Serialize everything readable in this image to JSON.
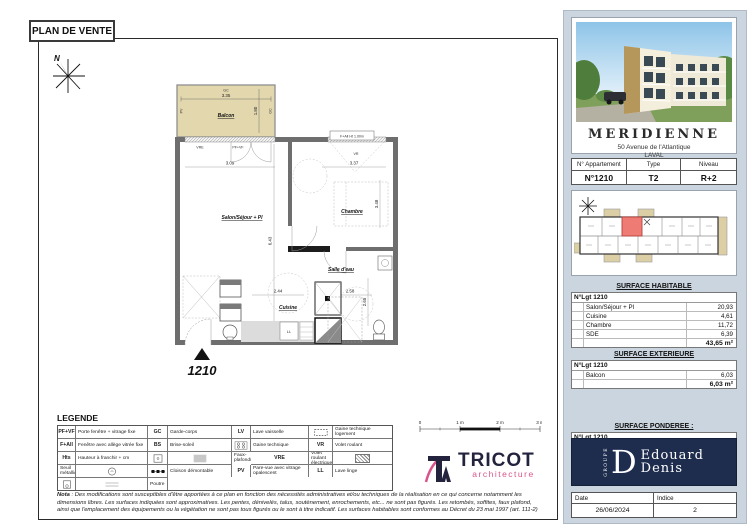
{
  "page": {
    "title": "PLAN DE VENTE"
  },
  "colors": {
    "highlight_red": "#ee7b74",
    "developer_navy": "#1e2c4e",
    "balcony_tan": "#e3d7ae",
    "architect_pink": "#d9548a",
    "panel_blue": "#cbd5df"
  },
  "plan": {
    "north": "N",
    "apartment_number": "1210",
    "rooms": {
      "balcon": "Balcon",
      "salon": "Salon/Séjour + Pl",
      "chambre": "Chambre",
      "salle_eau": "Salle d'eau",
      "cuisine": "Cuisine",
      "lave_linge": "LL"
    },
    "dims": {
      "balcon_width": "3.35",
      "balcon_depth": "1.80",
      "salon_window": "3.09",
      "chambre_window": "3.37",
      "chambre_depth": "3.48",
      "salon_length": "6.43",
      "cuisine_width": "2.44",
      "sde_width": "2.58",
      "sde_depth": "2.65"
    },
    "tags": {
      "gc_top": "GC",
      "gc_side": "GC",
      "pv_side": "PV",
      "vre": "VRE",
      "pfvf": "PF+VF",
      "vr": "VR",
      "fall": "F+All Ht 1.00m"
    }
  },
  "scalebar": {
    "labels": [
      "0",
      "1 m",
      "2 m",
      "3 m"
    ]
  },
  "legend": {
    "title": "LEGENDE",
    "rows": [
      [
        {
          "abbr": "PF+VF",
          "label": "Porte fenêtre + vitrage fixe"
        },
        {
          "abbr": "GC",
          "label": "Garde-corps"
        },
        {
          "abbr": "LV",
          "label": "Lave vaisselle"
        },
        {
          "icon": "gaine-technique-logement-icon",
          "label": "Gaine technique logement"
        }
      ],
      [
        {
          "abbr": "F+All",
          "label": "Fenêtre avec allège vitrée fixe"
        },
        {
          "abbr": "BS",
          "label": "Brise-soleil"
        },
        {
          "icon": "four-cuisson-icon",
          "label": "Four Cuisson"
        },
        {
          "icon": "gaine-technique-icon",
          "label": "Gaine technique"
        }
      ],
      [
        {
          "abbr": "VR",
          "label": "Volet roulant"
        },
        {
          "abbr": "Hts",
          "label": "Hauteur à franchir + cm"
        },
        {
          "icon": "refrigerateur-icon",
          "label": "Réfrigérateur"
        },
        {
          "icon": "faux-plafond-icon",
          "label": "Faux-plafond/soffite"
        }
      ],
      [
        {
          "abbr": "VRE",
          "label": "Volet roulant électrique"
        },
        {
          "icon": "seuil-metallique-icon",
          "label": "Seuil métallique"
        },
        {
          "icon": "ballon-eau-chaude-icon",
          "label": "Ballon eau chaude sanitaire"
        },
        {
          "icon": "cloison-demontable-icon",
          "label": "Cloison démontable"
        }
      ],
      [
        {
          "abbr": "PV",
          "label": "Pare-vue avec vitrage opalescent"
        },
        {
          "abbr": "LL",
          "label": "Lave linge"
        },
        {
          "icon": "chaudiere-gaz-icon",
          "label": "Chaudière gaz individuelle murale"
        },
        {
          "icon": "poutre-icon",
          "label": "Poutre"
        }
      ]
    ],
    "nota_label": "Nota",
    "nota_text": " : Des modifications sont susceptibles d'être apportées à ce plan en fonction des nécessités administratives et/ou techniques de la réalisation en ce qui concerne notamment les dimensions libres. Les surfaces indiquées sont approximatives. Les pentes, dénivelés, talus, soutènement, enrochements, etc... ne sont pas figurés. Les retombés, soffites, faux plafond, ainsi que l'emplacement des équipements ou la végétation ne sont pas tous figurés ou le sont à titre indicatif. Les surfaces habitables sont conformes au Décret du 23 mai 1997 (art. 111-2)"
  },
  "architect": {
    "monogram": "TA",
    "name": "TRICOT",
    "tagline": "architecture"
  },
  "sidebar": {
    "project": {
      "name": "MERIDIENNE",
      "address": "50 Avenue de l'Atlantique",
      "city": "LAVAL"
    },
    "info": {
      "headers": [
        "N° Appartement",
        "Type",
        "Niveau"
      ],
      "values": [
        "N°1210",
        "T2",
        "R+2"
      ]
    },
    "surface_habitable": {
      "title": "SURFACE HABITABLE",
      "lot": "N°Lgt  1210",
      "rows": [
        {
          "label": "Salon/Séjour + Pl",
          "value": "20,93"
        },
        {
          "label": "Cuisine",
          "value": "4,61"
        },
        {
          "label": "Chambre",
          "value": "11,72"
        },
        {
          "label": "SDE",
          "value": "6,39"
        }
      ],
      "total": "43,65 m²"
    },
    "surface_exterieure": {
      "title": "SURFACE EXTERIEURE",
      "lot": "N°Lgt  1210",
      "rows": [
        {
          "label": "Balcon",
          "value": "6,03"
        }
      ],
      "total": "6,03 m²"
    },
    "surface_ponderee": {
      "title": "SURFACE PONDEREE :",
      "lot": "N°Lgt  1210",
      "total": "46,67m²"
    },
    "developer": {
      "group": "GROUPE",
      "initial": "D",
      "line1": "Edouard",
      "line2": "Denis"
    },
    "footer": {
      "date_label": "Date",
      "date": "26/06/2024",
      "indice_label": "Indice",
      "indice": "2"
    }
  }
}
